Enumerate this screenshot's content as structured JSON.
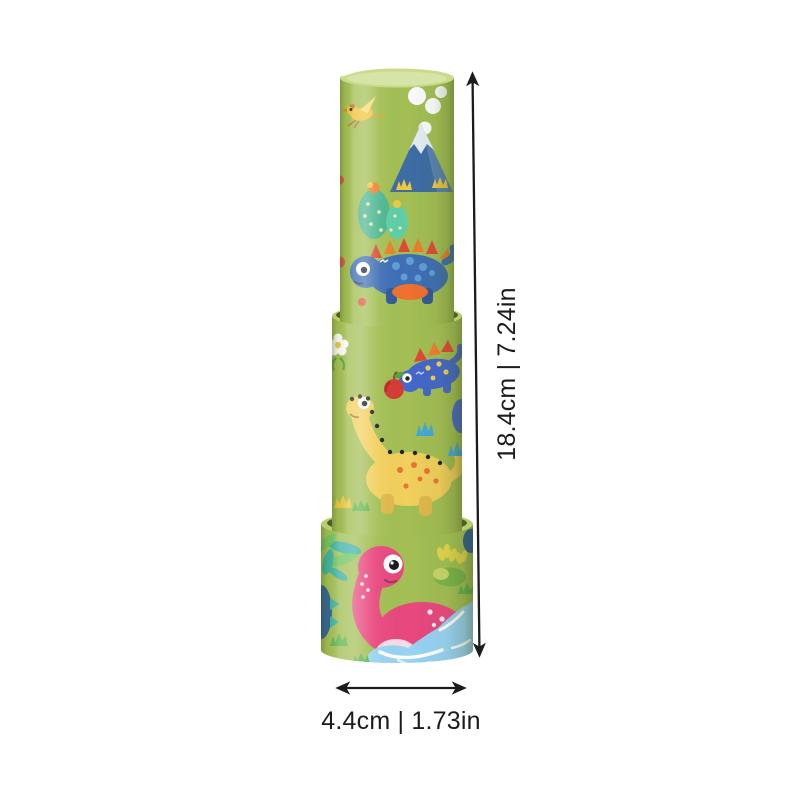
{
  "annotations": {
    "height_label": "18.4cm | 7.24in",
    "width_label": "4.4cm | 1.73in"
  },
  "product": {
    "type": "telescoping dinosaur kaleidoscope toy, three stacked green tubes",
    "motifs": [
      "bird",
      "smoke-clouds",
      "volcano",
      "cactus",
      "stegosaurus",
      "apple",
      "brachiosaurus",
      "plesiosaur",
      "palm-leaves",
      "bushes",
      "water-pond",
      "grass"
    ]
  },
  "colors": {
    "annotation_ink": "#1b1b1b",
    "tube_green": "#a3bf54",
    "tube_green_light": "#c8db8a",
    "tube_rim": "#b6ce6c",
    "joint_shadow": "#4f5d28",
    "stego_blue": "#3f6fb5",
    "stego_leg": "#32599a",
    "stego_spot": "#5f9fd6",
    "spike_orange": "#ef7f2e",
    "spike_red": "#e04a35",
    "belly_orange": "#f07030",
    "stego_indigo": "#4468cc",
    "dot_yellow": "#f2d05c",
    "apple_red": "#d63b35",
    "apple_leaf": "#5aa33c",
    "brachio_yellow": "#f2d05c",
    "brachio_leg": "#e0b94a",
    "brachio_spot": "#e8743a",
    "bump_black": "#222222",
    "nessie_pink": "#e9487f",
    "nessie_belly": "#f6dde6",
    "nessie_smile": "#9c3a5a",
    "water_blue": "#98d3f3",
    "palm_teal": "#3ab2a2",
    "palm_green": "#70c35f",
    "palm_blue": "#2e5f9c",
    "bush_yellow": "#e3d44c",
    "bush_green": "#79b549",
    "bush_light": "#c6d66a",
    "bird_yellow": "#f1c33c",
    "bird_wing": "#f6dc74",
    "bird_head": "#bc6a2e",
    "beak_orange": "#e07b28",
    "volcano_blue": "#3e6da6",
    "snow_white": "#e5eef5",
    "smoke_white": "#fbfdfe",
    "grass_green": "#5fb44c",
    "grass_blue": "#46a9d9",
    "grass_yellow": "#f0c93e",
    "red_accent": "#e25543"
  }
}
